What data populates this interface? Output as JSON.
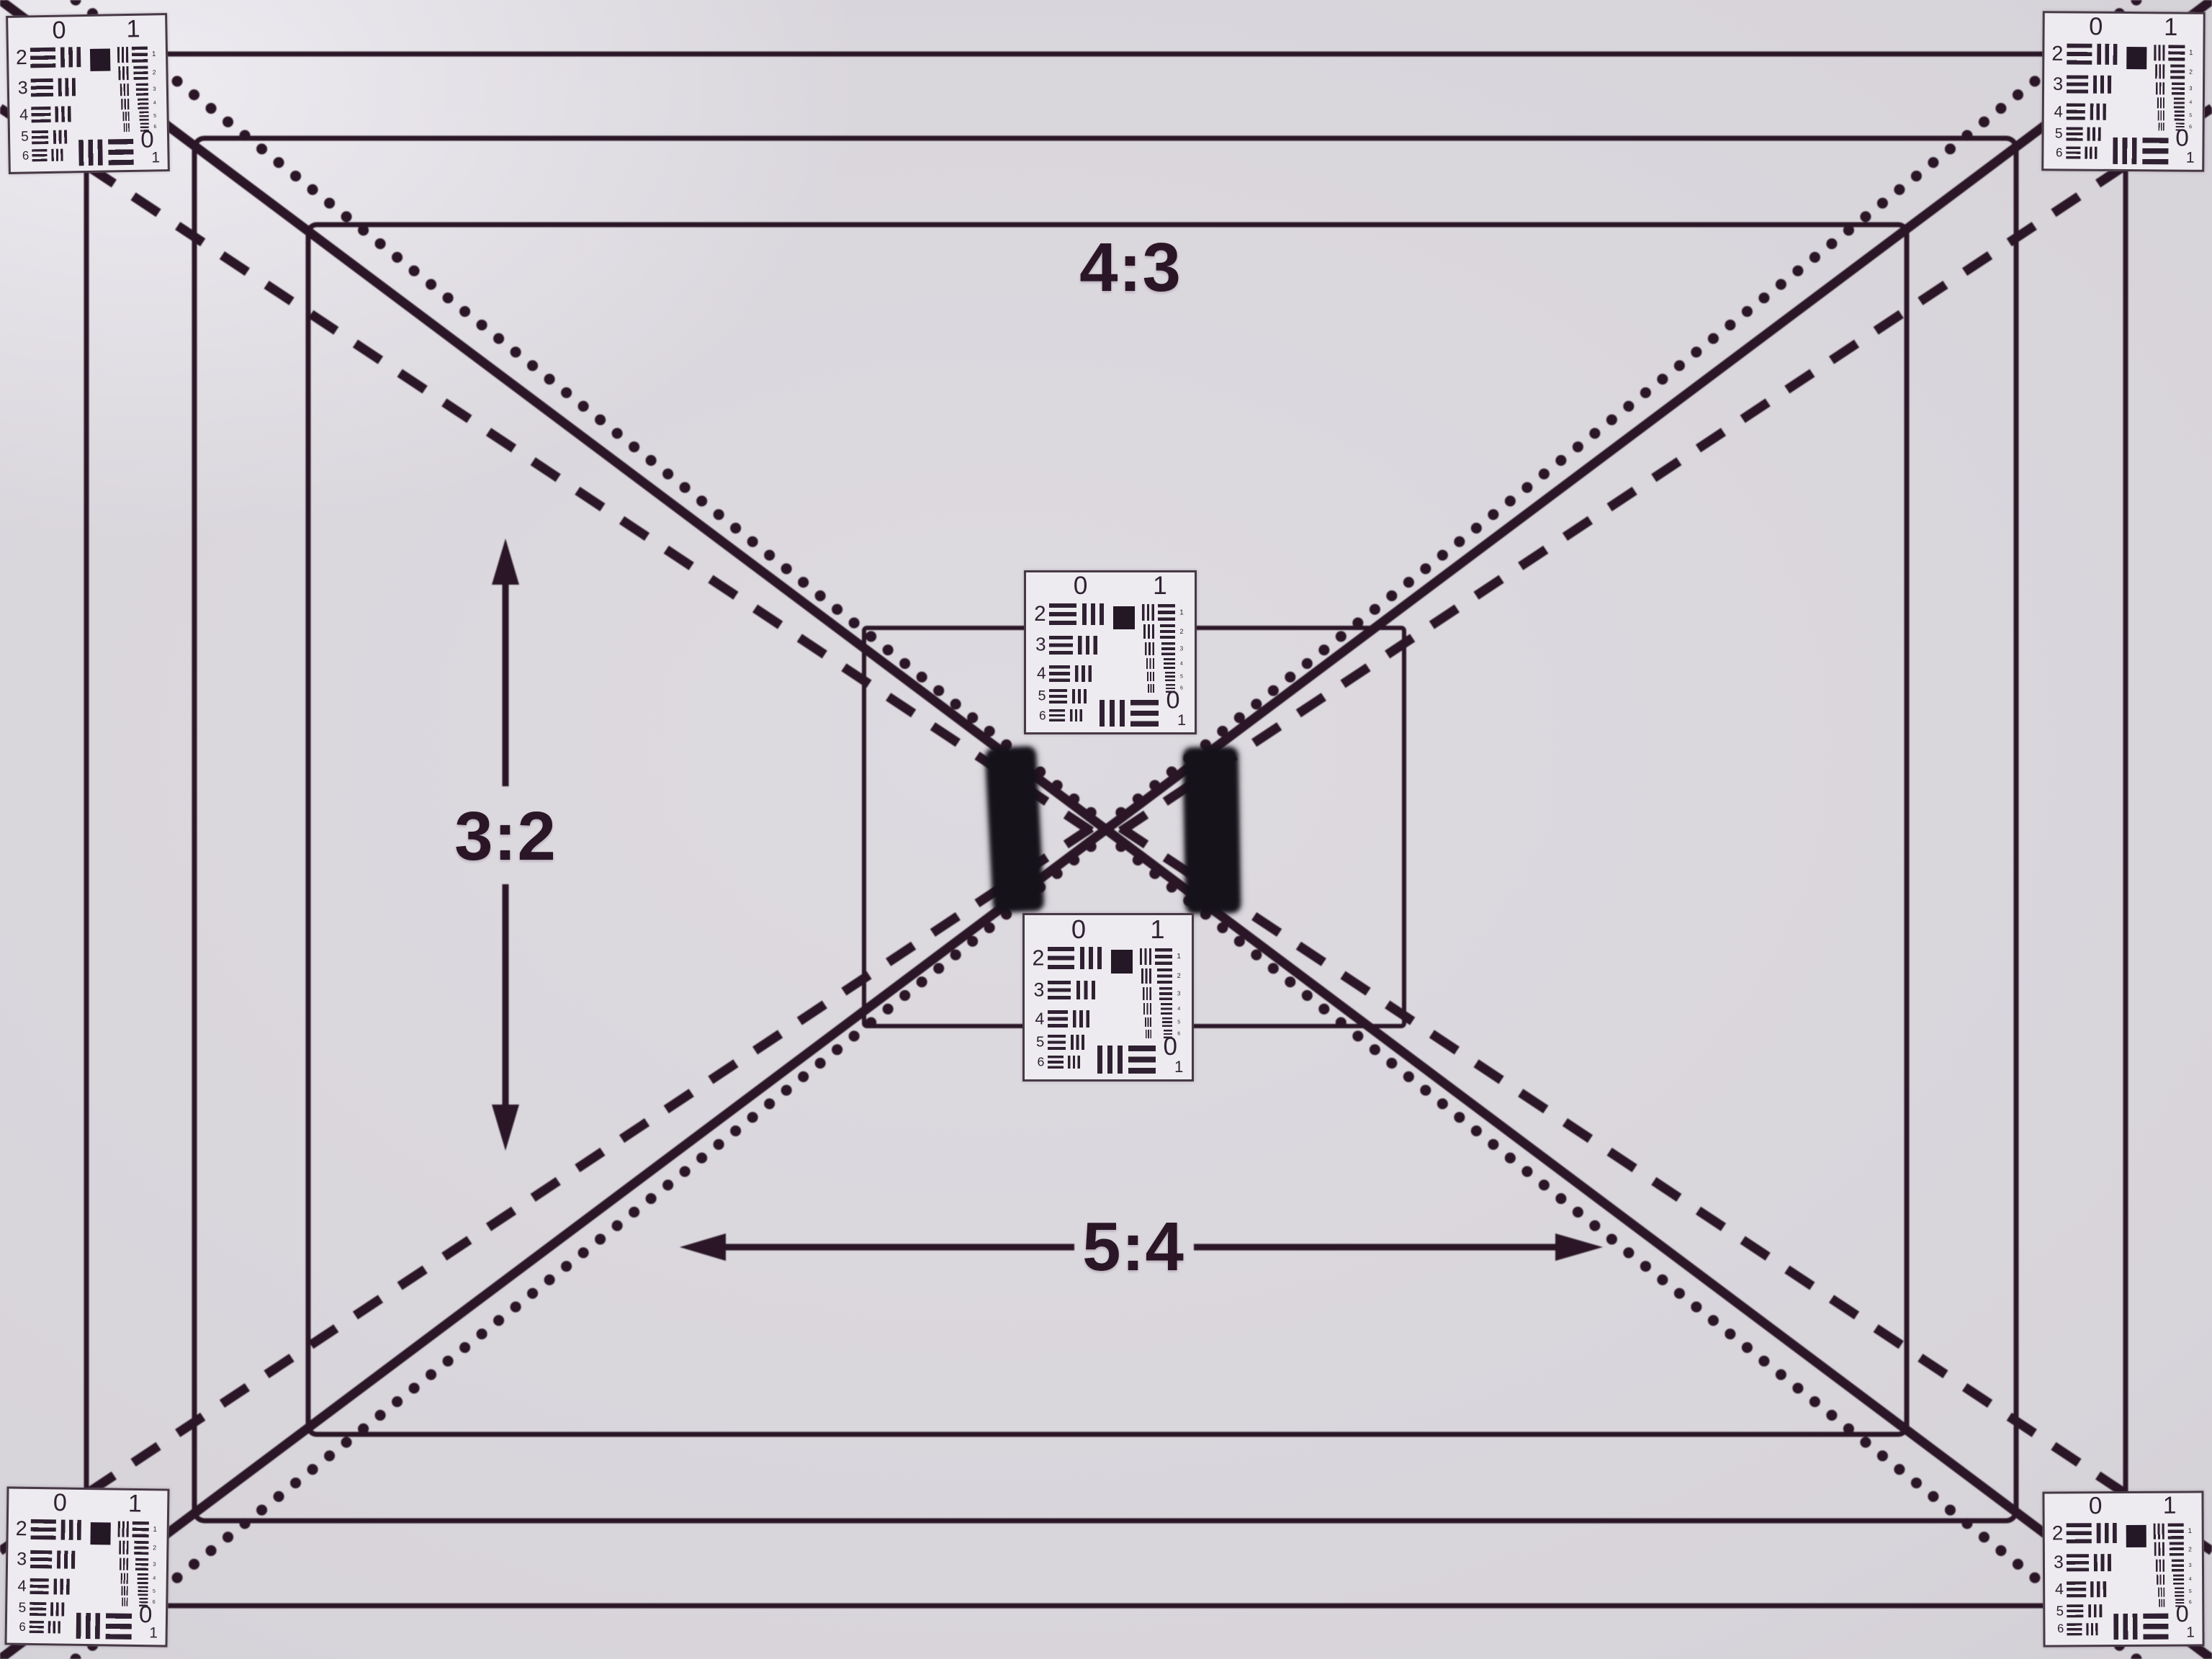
{
  "chart": {
    "kind": "lens-resolution-test-chart",
    "aspect_labels": {
      "top": "4:3",
      "left": "3:2",
      "bottom": "5:4"
    },
    "diagonal_line_styles": [
      "dotted",
      "solid",
      "dashed"
    ],
    "nested_rectangle_count": 4,
    "colors": {
      "paper": "#d7d4da",
      "paper_bright": "#e9e7ec",
      "paper_shade": "#c5c1c8",
      "ink": "#2a1626",
      "target_background": "#edebef",
      "target_ink": "#2f2132",
      "patch_black": "#16121a"
    }
  },
  "usaf_target": {
    "top_group_labels": [
      "0",
      "1"
    ],
    "left_element_labels": [
      "2",
      "3",
      "4",
      "5",
      "6"
    ],
    "right_element_indices": [
      "1",
      "2",
      "3",
      "4",
      "5",
      "6"
    ],
    "bottom_right_labels": [
      "0",
      "1"
    ],
    "positions": [
      "top-left",
      "top-right",
      "bottom-left",
      "bottom-right",
      "center-upper",
      "center-lower"
    ]
  }
}
